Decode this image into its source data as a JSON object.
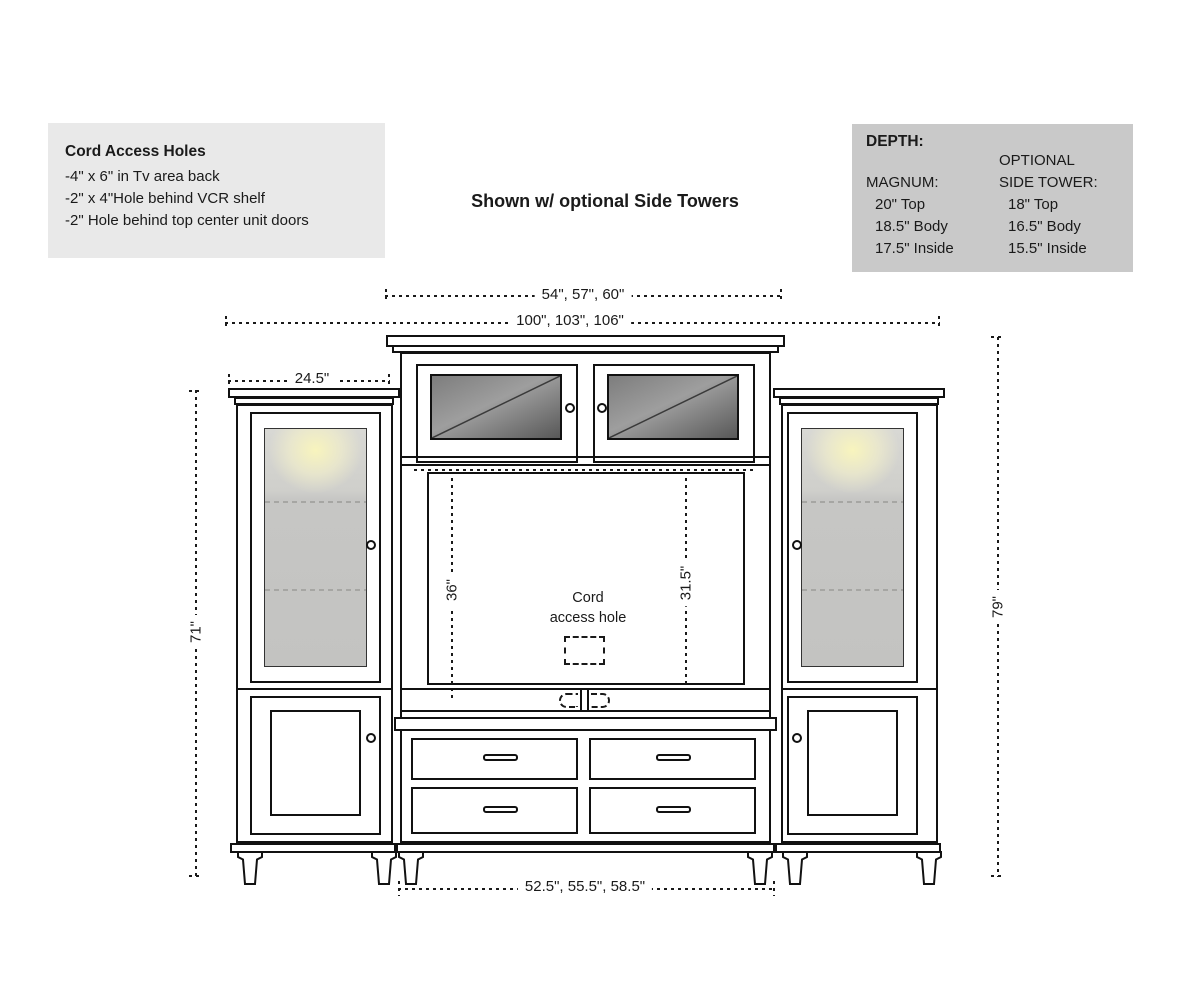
{
  "title": "Shown w/ optional Side Towers",
  "notes_box": {
    "title": "Cord Access Holes",
    "line1": "-4\" x 6\" in Tv area back",
    "line2": "-2\" x 4\"Hole behind VCR shelf",
    "line3": "-2\" Hole behind top center unit doors"
  },
  "depth_box": {
    "title": "DEPTH:",
    "magnum": {
      "header": "MAGNUM:",
      "row1": "20\" Top",
      "row2": "18.5\" Body",
      "row3": "17.5\" Inside"
    },
    "side_tower": {
      "header_line1": "OPTIONAL",
      "header_line2": "SIDE TOWER:",
      "row1": "18\" Top",
      "row2": "16.5\" Body",
      "row3": "15.5\" Inside"
    }
  },
  "dimensions": {
    "center_width": "54\", 57\", 60\"",
    "overall_width": "100\", 103\", 106\"",
    "tower_width": "24.5\"",
    "tower_height": "71\"",
    "overall_height": "79\"",
    "tv_height": "36\"",
    "tv_height_alt": "31.5\"",
    "base_width": "52.5\", 55.5\", 58.5\""
  },
  "labels": {
    "cord_line1": "Cord",
    "cord_line2": "access hole"
  },
  "colors": {
    "line": "#1a1a1a",
    "notes_box_bg": "#e9e9e9",
    "depth_box_bg": "#c9c9c9",
    "bridge_glass_dark": "#585858",
    "bridge_glass_light": "#9e9e9e",
    "tower_glass": "#c6c6c4",
    "lamp_glow": "#faf6bc"
  }
}
